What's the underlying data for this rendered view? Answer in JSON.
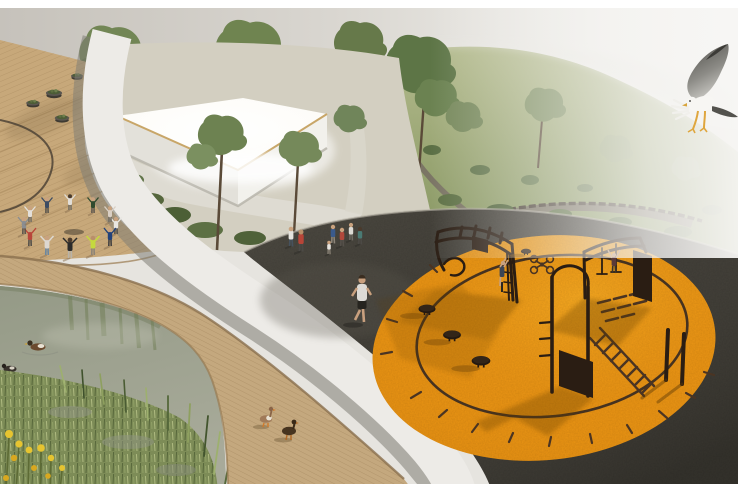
{
  "scene": {
    "kind": "3D landscape-architecture render of a riverside park, aerial perspective",
    "colors": {
      "frame": "#ffffff",
      "sky_left": "#c8c4bd",
      "sky_right": "#f6f5f3",
      "deck_wood": "#c7a87a",
      "boardwalk_wood": "#c4a87e",
      "path_white": "#edebe7",
      "path_curb": "#85827a",
      "asphalt": "#45423b",
      "fitness_orange": "#ec9514",
      "fitness_ring": "#453220",
      "equipment": "#2a1d13",
      "hill_green": "#9aa674",
      "shrub_green": "#55683e",
      "tree_green": "#6f8451",
      "pond_water": "#a3a795",
      "marsh_green": "#7d8c57",
      "flower_yellow": "#e6c430",
      "duck_brown": "#6b4a2e",
      "gull_wing": "#5e5d58",
      "gull_body": "#f7f6f3",
      "gull_feet": "#dfa63e",
      "pavilion_wall": "#e9e7e0",
      "roof_glow": "#ffffff"
    },
    "objects": {
      "seagull": "seagull landing in the sky, top right",
      "pavilion": "white flat-roofed pavilion with glowing canopy among trees",
      "fitness_circle": "circular orange rubber calisthenics area on asphalt plaza",
      "drone_marking": "quadcopter pictogram painted on the orange surface",
      "ladder_marking": "agility ladder painted on the orange surface",
      "dancers": "group dancing in a circle holding hands on the wooden deck",
      "walkers": "people strolling on the asphalt plaza",
      "jogger": "man jogging toward the viewer",
      "ducks_pond": "ducks swimming in the pond",
      "ducks_boardwalk": "ducks walking on the boardwalk",
      "planters": "round planter bowls on the stepped deck",
      "hill_path": "gravel trail winding through the meadow hill"
    },
    "counts": {
      "dancers": 12,
      "walkers": 7,
      "jogger": 1,
      "climbers": 2,
      "ducks_swimming": 2,
      "ducks_walking": 2,
      "planters": 5,
      "fitness_rigs": 3,
      "steppers": 4,
      "balance_poles": 2
    }
  }
}
